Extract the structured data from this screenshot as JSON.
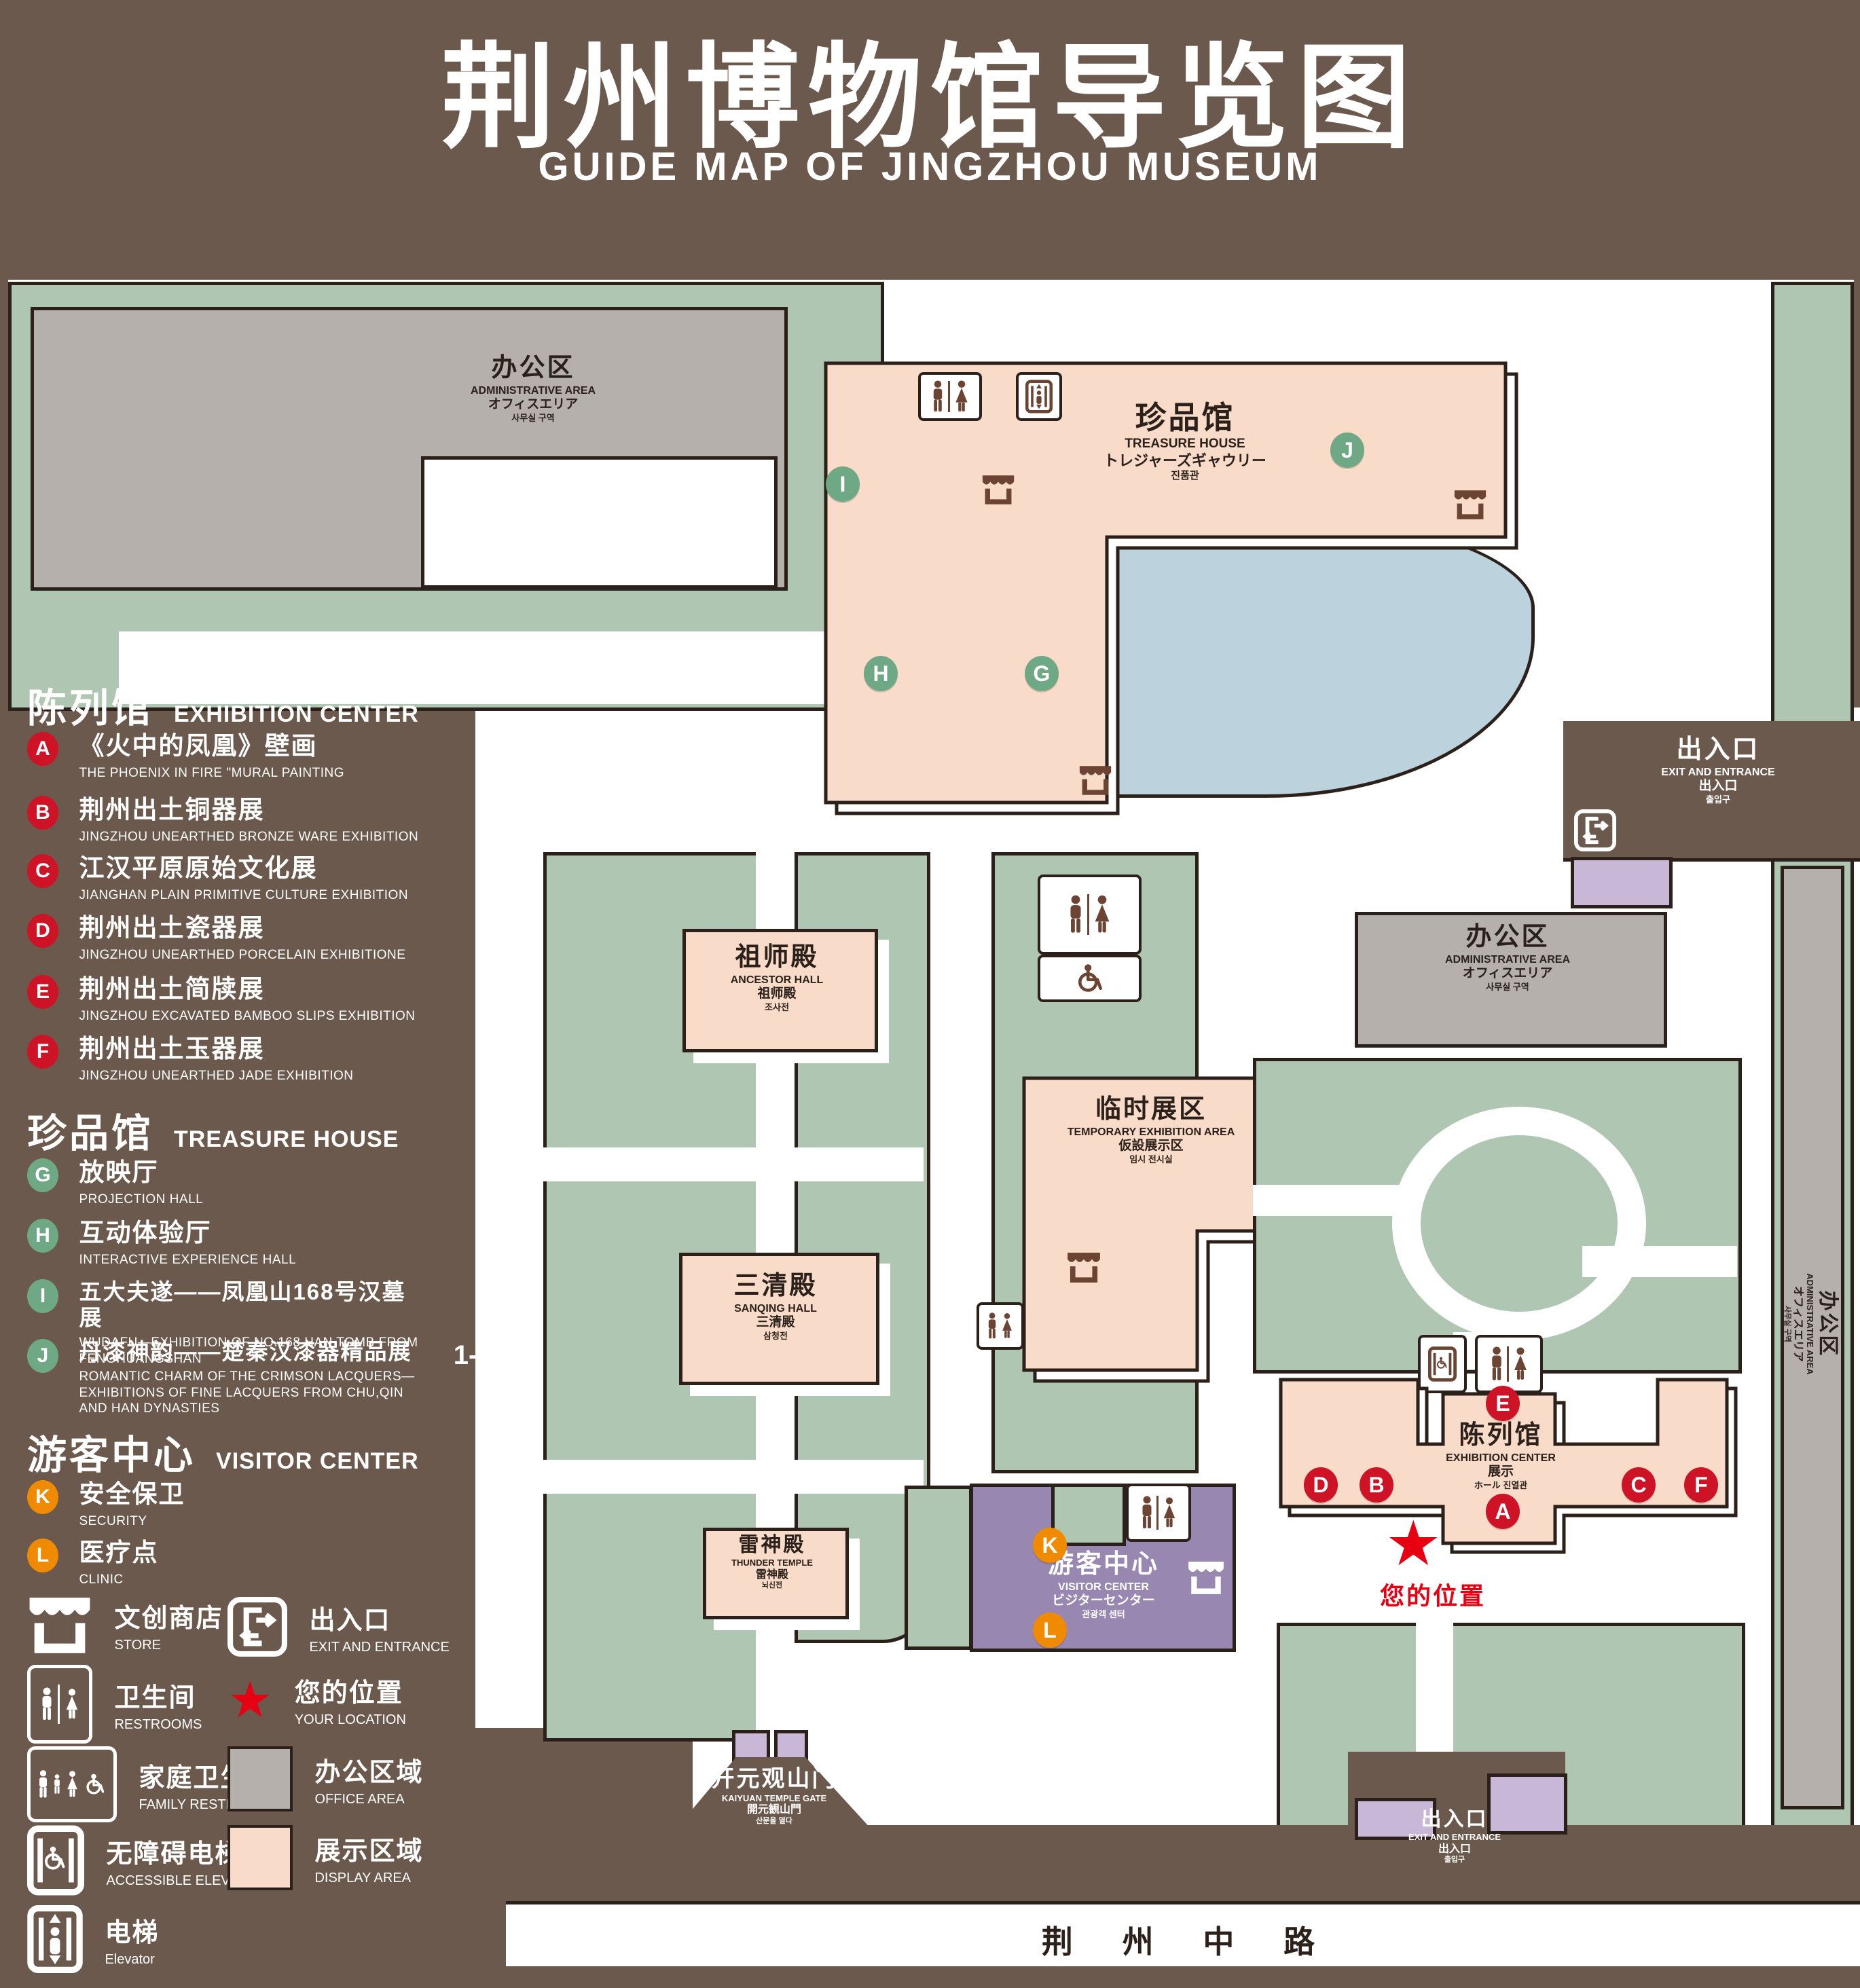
{
  "title": {
    "zh": "荆州博物馆导览图",
    "en": "GUIDE MAP OF JINGZHOU MUSEUM"
  },
  "colors": {
    "background_brown": "#6a594c",
    "courtyard_green": "#afc6b3",
    "display_pink": "#f8dbc8",
    "office_gray": "#b5b0ab",
    "visitor_purple": "#9887b1",
    "entrance_lavender": "#c9b7d8",
    "lake_blue": "#bcd3de",
    "marker_red": "#cf1326",
    "marker_green": "#6fa884",
    "marker_orange": "#f08a00",
    "location_red": "#e60012",
    "outline_ink": "#2b211a"
  },
  "legend": {
    "sections": [
      {
        "zh": "陈列馆",
        "en": "EXHIBITION CENTER",
        "items": [
          {
            "letter": "A",
            "zh": "《火中的凤凰》壁画",
            "en": "THE PHOENIX IN FIRE \"MURAL PAINTING",
            "floor": "1F"
          },
          {
            "letter": "B",
            "zh": "荆州出土铜器展",
            "en": "JINGZHOU UNEARTHED BRONZE WARE EXHIBITION",
            "floor": "1F"
          },
          {
            "letter": "C",
            "zh": "江汉平原原始文化展",
            "en": "JIANGHAN PLAIN PRIMITIVE CULTURE EXHIBITION",
            "floor": "1F"
          },
          {
            "letter": "D",
            "zh": "荆州出土瓷器展",
            "en": "JINGZHOU UNEARTHED PORCELAIN EXHIBITIONE",
            "floor": "2F"
          },
          {
            "letter": "E",
            "zh": "荆州出土简牍展",
            "en": "JINGZHOU EXCAVATED BAMBOO SLIPS EXHIBITION",
            "floor": "2F"
          },
          {
            "letter": "F",
            "zh": "荆州出土玉器展",
            "en": "JINGZHOU UNEARTHED JADE EXHIBITION",
            "floor": "2F"
          }
        ]
      },
      {
        "zh": "珍品馆",
        "en": "TREASURE HOUSE",
        "items": [
          {
            "letter": "G",
            "zh": "放映厅",
            "en": "PROJECTION HALL",
            "floor": "1F"
          },
          {
            "letter": "H",
            "zh": "互动体验厅",
            "en": "INTERACTIVE EXPERIENCE HALL",
            "floor": "1F"
          },
          {
            "letter": "I",
            "zh": "五大夫遂——凤凰山168号汉墓展",
            "en": "WUDAFU—EXHIBITION OF NO.168 HAN TOMB FROM FENGHUANGSHAN",
            "floor": "2F"
          },
          {
            "letter": "J",
            "zh": "丹漆神韵——楚秦汉漆器精品展",
            "en": "ROMANTIC CHARM OF THE CRIMSON LACQUERS—EXHIBITIONS OF FINE LACQUERS FROM CHU,QIN AND HAN DYNASTIES",
            "floor": "1-2F"
          }
        ]
      },
      {
        "zh": "游客中心",
        "en": "VISITOR CENTER",
        "items": [
          {
            "letter": "K",
            "zh": "安全保卫",
            "en": "SECURITY",
            "floor": "1F"
          },
          {
            "letter": "L",
            "zh": "医疗点",
            "en": "CLINIC",
            "floor": "1F"
          }
        ]
      }
    ],
    "symbols": [
      {
        "icon": "store-icon",
        "zh": "文创商店",
        "en": "STORE"
      },
      {
        "icon": "exit-icon",
        "zh": "出入口",
        "en": "EXIT AND ENTRANCE"
      },
      {
        "icon": "restroom-icon",
        "zh": "卫生间",
        "en": "RESTROOMS"
      },
      {
        "icon": "location-star-icon",
        "zh": "您的位置",
        "en": "YOUR LOCATION"
      },
      {
        "icon": "family-restroom-icon",
        "zh": "家庭卫生间",
        "en": "FAMILY RESTROOMS"
      },
      {
        "icon": "office-area-swatch",
        "zh": "办公区域",
        "en": "OFFICE AREA"
      },
      {
        "icon": "accessible-elevator-icon",
        "zh": "无障碍电梯",
        "en": "ACCESSIBLE ELEVATOR"
      },
      {
        "icon": "display-area-swatch",
        "zh": "展示区域",
        "en": "DISPLAY AREA"
      },
      {
        "icon": "elevator-icon",
        "zh": "电梯",
        "en": "Elevator"
      }
    ]
  },
  "map": {
    "buildings": {
      "admin": {
        "zh": "办公区",
        "en": "ADMINISTRATIVE AREA",
        "ja": "オフィスエリア",
        "ko": "사무실 구역"
      },
      "treasure_house": {
        "zh": "珍品馆",
        "en": "TREASURE HOUSE",
        "ja": "トレジャーズギャウリー",
        "ko": "진품관"
      },
      "ancestor_hall": {
        "zh": "祖师殿",
        "en": "ANCESTOR HALL",
        "ja": "祖师殿",
        "ko": "조사전"
      },
      "temporary_exhibition": {
        "zh": "临时展区",
        "en": "TEMPORARY EXHIBITION AREA",
        "ja": "仮設展示区",
        "ko": "임시 전시실"
      },
      "sanqing_hall": {
        "zh": "三清殿",
        "en": "SANQING HALL",
        "ja": "三清殿",
        "ko": "삼청전"
      },
      "thunder_temple": {
        "zh": "雷神殿",
        "en": "THUNDER TEMPLE",
        "ja": "雷神殿",
        "ko": "뇌신전"
      },
      "visitor_center": {
        "zh": "游客中心",
        "en": "VISITOR CENTER",
        "ja": "ビジターセンター",
        "ko": "관광객 센터"
      },
      "exhibition_center": {
        "zh": "陈列馆",
        "en": "EXHIBITION CENTER",
        "ja": "展示",
        "ko": "ホール 진열관"
      },
      "kaiyuan_gate": {
        "zh": "开元观山门",
        "en": "KAIYUAN TEMPLE GATE",
        "ja": "開元観山門",
        "ko": "산문을 열다"
      }
    },
    "exit": {
      "zh": "出入口",
      "en": "EXIT AND ENTRANCE",
      "ja": "出入口",
      "ko": "출입구"
    },
    "road": "荆 州 中 路",
    "your_location": "您的位置",
    "markers": [
      "A",
      "B",
      "C",
      "D",
      "E",
      "F",
      "G",
      "H",
      "I",
      "J",
      "K",
      "L"
    ]
  }
}
